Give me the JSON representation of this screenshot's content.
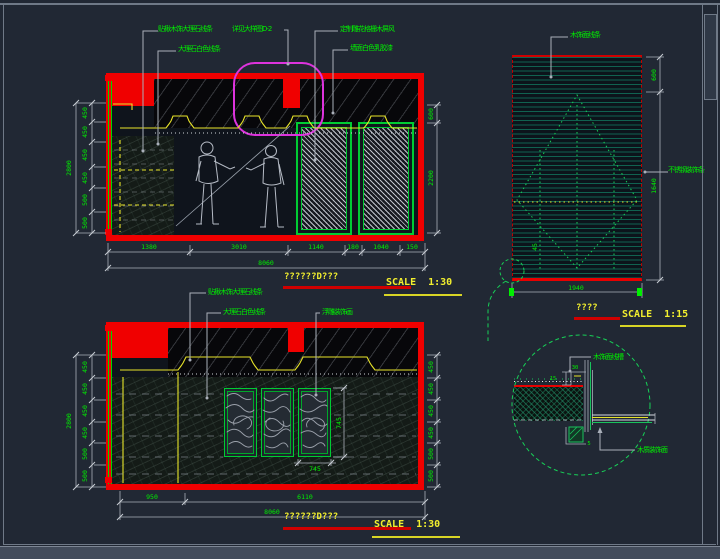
{
  "colors": {
    "red": "#ff0000",
    "green": "#00ef00",
    "yellow": "#f2ef2e",
    "magenta": "#dd33dd",
    "teal": "#106250",
    "background": "#212834"
  },
  "elev_a": {
    "labels": {
      "marble_trim": "贴楸木饰大理石线条",
      "marble_white": "大理石白色线条",
      "see_detail": "详见大样图D-2",
      "carved_screen": "定制雕花格栅木屏风",
      "latex_paint": "墙面白色乳胶漆"
    },
    "dims_bottom": [
      "1380",
      "3010",
      "1140",
      "180",
      "1040",
      "150"
    ],
    "dims_bottom_total": "8060",
    "dims_left": [
      "450",
      "450",
      "450",
      "450",
      "500",
      "500"
    ],
    "dims_left_total": "2800",
    "dims_right": [
      "600",
      "2200"
    ],
    "title": "??????D???",
    "scale_label": "SCALE",
    "scale_value": "1:30"
  },
  "elev_b": {
    "labels": {
      "marble_trim": "贴楸木饰大理石线条",
      "marble_white": "大理石白色线条",
      "relief_art": "浮雕装饰画"
    },
    "dims_bottom": [
      "950",
      "6110"
    ],
    "dims_bottom_total": "8060",
    "dims_left": [
      "450",
      "450",
      "450",
      "450",
      "500",
      "500"
    ],
    "dims_left_total": "2800",
    "dims_right": [
      "450",
      "450",
      "450",
      "450",
      "500",
      "500"
    ],
    "panel_dim_vertical": "745",
    "panel_dim_horizontal": "745",
    "title": "??????D???",
    "scale_label": "SCALE",
    "scale_value": "1:30"
  },
  "panel_detail": {
    "labels": {
      "wood_trim": "木饰面线条",
      "stainless_trim": "不锈钢装饰条"
    },
    "dims": {
      "right_top": "600",
      "right_bottom": "1640",
      "bottom": "1940",
      "inner": "45"
    },
    "title": "????",
    "scale_label": "SCALE",
    "scale_value": "1:15"
  },
  "node_detail": {
    "labels": {
      "wood_groove": "木饰面线槽",
      "wood_face": "木质装饰面"
    },
    "dims": {
      "d1": "30",
      "d2": "15",
      "d3": "5"
    }
  }
}
